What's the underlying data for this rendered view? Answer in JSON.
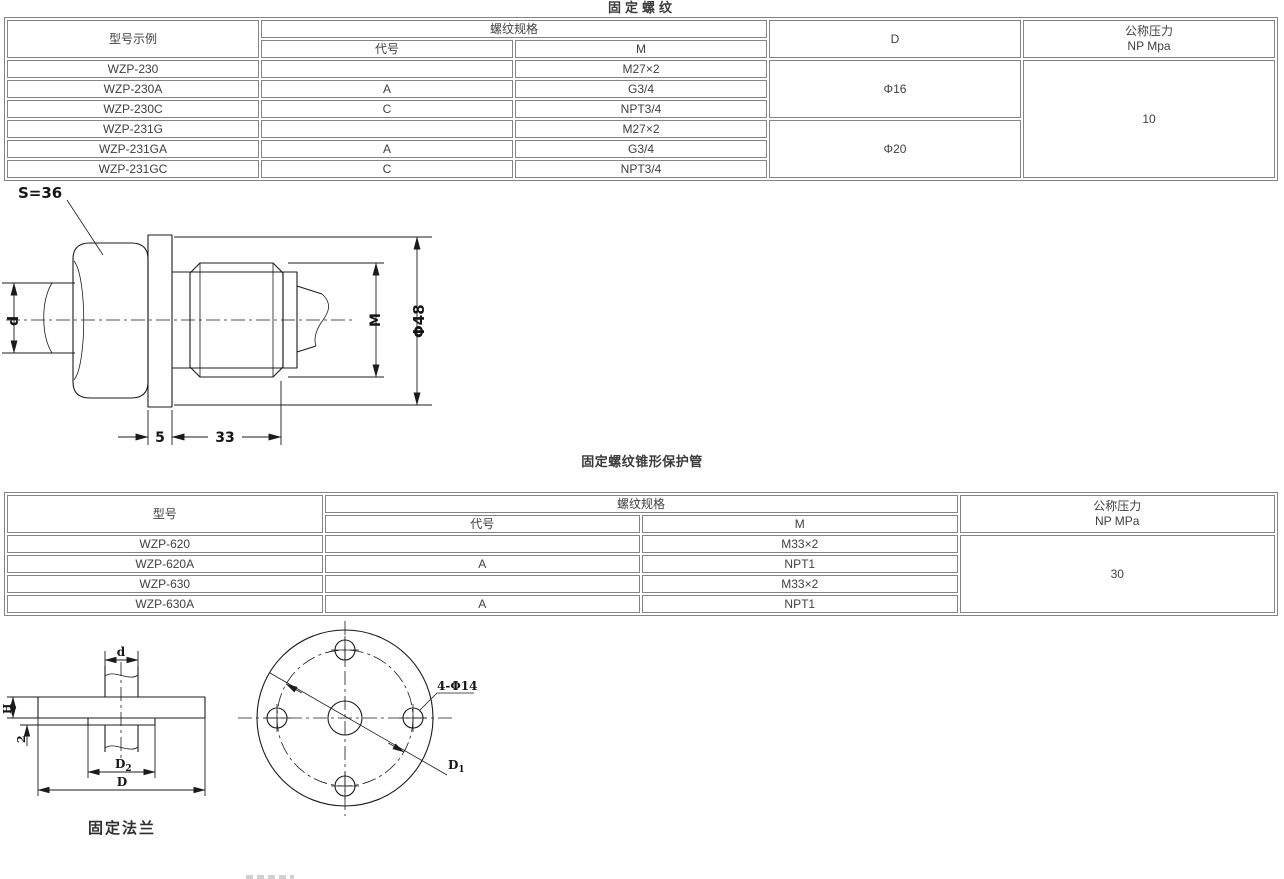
{
  "section1": {
    "title": "固定螺纹",
    "table": {
      "col_model": "型号示例",
      "col_thread": "螺纹规格",
      "col_code": "代号",
      "col_m": "M",
      "col_d": "D",
      "col_pressure_1": "公称压力",
      "col_pressure_2": "NP Mpa",
      "rows": [
        {
          "model": "WZP-230",
          "code": "",
          "m": "M27×2"
        },
        {
          "model": "WZP-230A",
          "code": "A",
          "m": "G3/4"
        },
        {
          "model": "WZP-230C",
          "code": "C",
          "m": "NPT3/4"
        },
        {
          "model": "WZP-231G",
          "code": "",
          "m": "M27×2"
        },
        {
          "model": "WZP-231GA",
          "code": "A",
          "m": "G3/4"
        },
        {
          "model": "WZP-231GC",
          "code": "C",
          "m": "NPT3/4"
        }
      ],
      "d_values": [
        "Φ16",
        "Φ20"
      ],
      "pressure": "10"
    },
    "drawing": {
      "s36": "S=36",
      "d": "d",
      "m": "M",
      "phi48": "Φ48",
      "dim5": "5",
      "dim33": "33"
    }
  },
  "section2": {
    "title": "固定螺纹锥形保护管",
    "table": {
      "col_model": "型号",
      "col_thread": "螺纹规格",
      "col_code": "代号",
      "col_m": "M",
      "col_pressure_1": "公称压力",
      "col_pressure_2": "NP MPa",
      "rows": [
        {
          "model": "WZP-620",
          "code": "",
          "m": "M33×2"
        },
        {
          "model": "WZP-620A",
          "code": "A",
          "m": "NPT1"
        },
        {
          "model": "WZP-630",
          "code": "",
          "m": "M33×2"
        },
        {
          "model": "WZP-630A",
          "code": "A",
          "m": "NPT1"
        }
      ],
      "pressure": "30"
    },
    "flange": {
      "caption": "固定法兰",
      "d": "d",
      "h": "H",
      "two": "2",
      "D": "D",
      "D2_main": "D",
      "D2_sub": "2",
      "holes": "4-Φ14",
      "D1_main": "D",
      "D1_sub": "1"
    }
  }
}
